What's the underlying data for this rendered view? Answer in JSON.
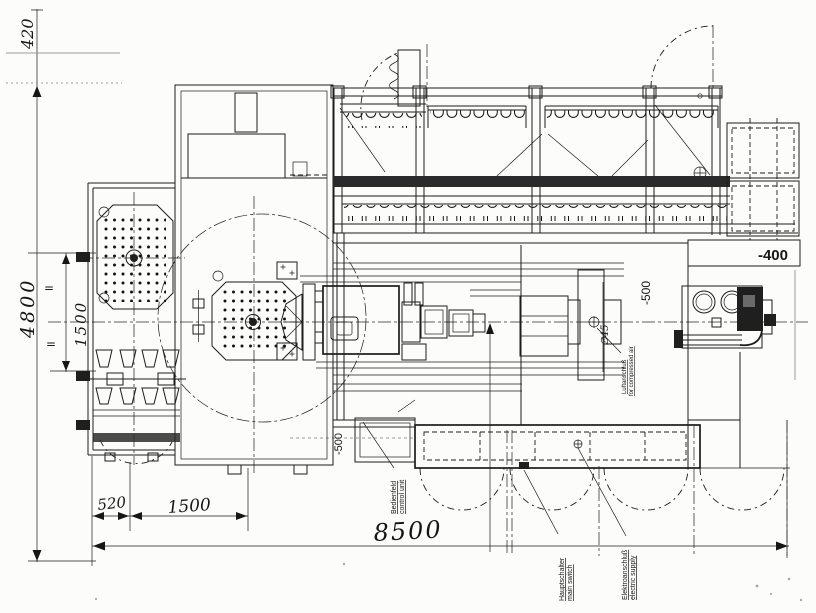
{
  "drawing": {
    "dims": {
      "top": "420",
      "left_overall": "4800",
      "left_inner": "1500",
      "eq1": "=",
      "eq2": "=",
      "bottom_small": "520",
      "bottom_mid": "1500",
      "bottom_overall": "8500"
    },
    "levels": {
      "pit_right": "-400",
      "pit_col": "-500",
      "pit_left": "-500"
    },
    "labels": {
      "air_dia": "∅45",
      "air_de": "Luftanschluß",
      "air_en": "for compressed air",
      "control_de": "Bedienfeld",
      "control_en": "control unit",
      "switch_de": "Hauptschalter",
      "switch_en": "main switch",
      "supply_de": "Elektroanschluß",
      "supply_en": "electric supply"
    }
  }
}
